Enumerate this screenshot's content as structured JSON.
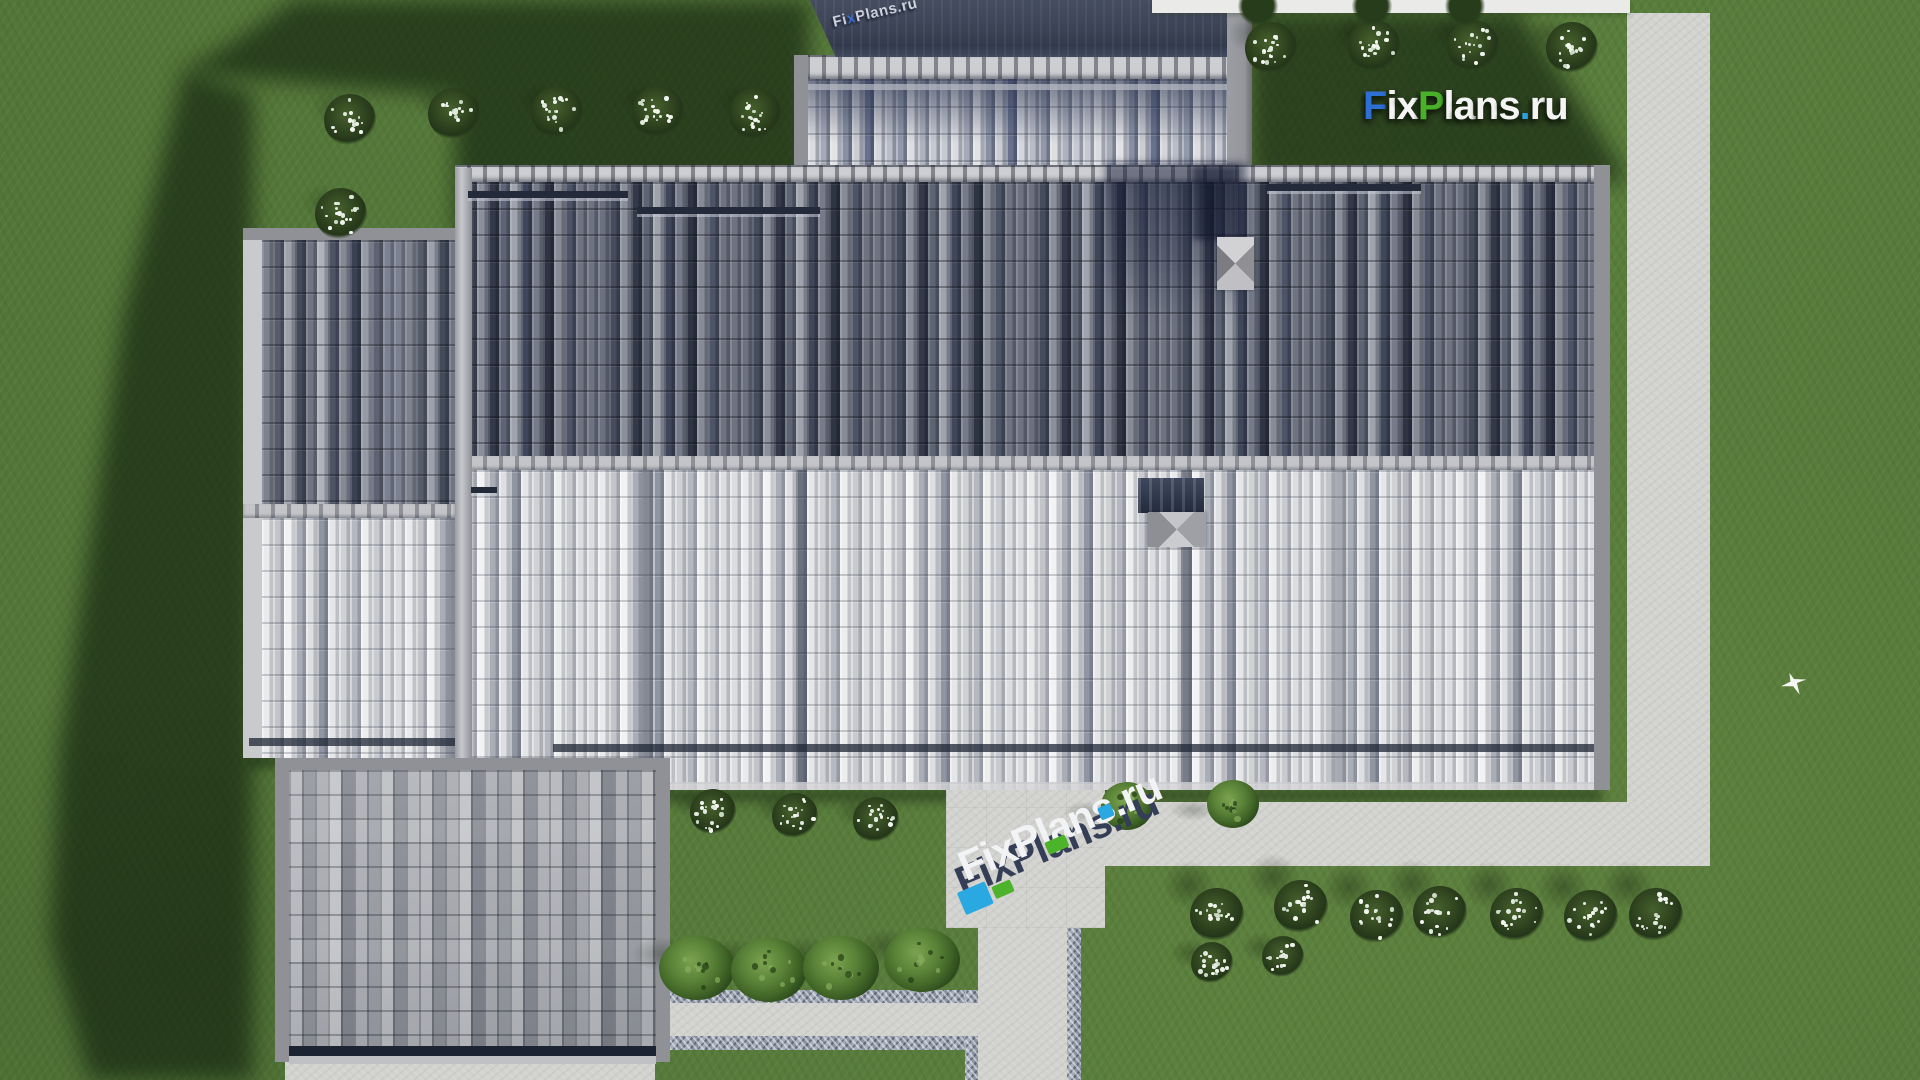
{
  "branding": {
    "logo_text": "FixPlans.ru",
    "logo_letters": [
      {
        "ch": "F",
        "color": "#2e6fd4"
      },
      {
        "ch": "i",
        "color": "#f4f4f4"
      },
      {
        "ch": "x",
        "color": "#f4f4f4"
      },
      {
        "ch": "P",
        "color": "#49b02a"
      },
      {
        "ch": "l",
        "color": "#f4f4f4"
      },
      {
        "ch": "a",
        "color": "#f4f4f4"
      },
      {
        "ch": "n",
        "color": "#f4f4f4"
      },
      {
        "ch": "s",
        "color": "#f4f4f4"
      },
      {
        "ch": ".",
        "color": "#2aa5e2"
      },
      {
        "ch": "r",
        "color": "#f4f4f4"
      },
      {
        "ch": "u",
        "color": "#f4f4f4"
      }
    ],
    "logo_rect": [
      1363,
      84,
      230,
      42
    ],
    "watermark_center": {
      "text": "FixPlans.ru",
      "pos": [
        948,
        862
      ],
      "rotation_deg": -23,
      "face_color": "#343e57",
      "top_color": "#f2f3f5",
      "accents": [
        {
          "x": -4,
          "y": 32,
          "w": 30,
          "h": 24,
          "color": "#29a8e2"
        },
        {
          "x": 30,
          "y": 40,
          "w": 20,
          "h": 13,
          "color": "#4db32a"
        },
        {
          "x": 96,
          "y": 20,
          "w": 22,
          "h": 13,
          "color": "#4db32a"
        },
        {
          "x": 158,
          "y": 9,
          "w": 14,
          "h": 13,
          "color": "#29a8e2"
        }
      ]
    },
    "watermark_top": {
      "text": "FixPlans.ru",
      "pos": [
        833,
        14
      ],
      "rotation_deg": -13,
      "color": "#dde2ea",
      "accent_index": 2,
      "accent_color": "#3b74d8"
    }
  },
  "scene": {
    "colors": {
      "grass": "#567a3a",
      "grass_shadow": "#1c2e15",
      "concrete": "#d2d2cf",
      "gravel": "#9aa2b0",
      "navy_roof": "#3a4254",
      "dark_tiles": "#59606e",
      "light_tiles": "#d7d8db"
    },
    "paths": {
      "right_path": [
        1627,
        13,
        83,
        853
      ],
      "h_path": [
        1105,
        802,
        605,
        64
      ],
      "patio": [
        946,
        790,
        159,
        138
      ],
      "walk": [
        978,
        928,
        89,
        152
      ],
      "walk_gravel_r": [
        1067,
        928,
        14,
        152
      ],
      "walk_gravel_l": [
        965,
        990,
        13,
        90
      ],
      "bpath_gravel_t": [
        670,
        990,
        295,
        13
      ],
      "bpath_concrete": [
        670,
        1003,
        308,
        33
      ],
      "bpath_gravel_b": [
        670,
        1036,
        295,
        14
      ],
      "bottom_strip": [
        285,
        1062,
        370,
        18
      ],
      "white_band": [
        1152,
        0,
        478,
        13
      ],
      "dormer_strip": [
        1227,
        12,
        25,
        153
      ]
    },
    "roof": {
      "lw_left_fascia": [
        243,
        228,
        19,
        530
      ],
      "lw_top_fascia": [
        243,
        228,
        212,
        12
      ],
      "lw_dark": [
        262,
        240,
        193,
        264
      ],
      "lw_ridge": [
        243,
        504,
        212,
        14
      ],
      "lw_light": [
        262,
        518,
        193,
        240
      ],
      "lw_gutter": [
        249,
        738,
        206,
        8
      ],
      "main_topridge": [
        455,
        165,
        1147,
        17
      ],
      "main_dark": [
        455,
        182,
        1147,
        274
      ],
      "main_ridge": [
        455,
        456,
        1147,
        14
      ],
      "main_light": [
        455,
        470,
        1147,
        320
      ],
      "main_right_fascia": [
        1594,
        165,
        16,
        625
      ],
      "divider": [
        455,
        168,
        17,
        622
      ],
      "snowguard1": [
        468,
        191,
        160,
        7
      ],
      "snowguard2": [
        637,
        207,
        183,
        7
      ],
      "snowguard3": [
        1267,
        184,
        154,
        7
      ],
      "vent_mark": [
        471,
        487,
        26,
        6
      ],
      "main_gutter": [
        553,
        744,
        1041,
        8
      ],
      "main_fascia_line": [
        670,
        782,
        924,
        8
      ],
      "blr_fascia_t": [
        275,
        758,
        395,
        12
      ],
      "blr_fascia_l": [
        275,
        758,
        14,
        304
      ],
      "blr_fascia_r": [
        656,
        758,
        14,
        304
      ],
      "blr_tiles": [
        289,
        770,
        367,
        292
      ],
      "blr_gutter": [
        289,
        1046,
        367,
        10
      ],
      "blr_lightrow": [
        289,
        1056,
        367,
        8
      ],
      "dormer_fascia_l": [
        794,
        55,
        14,
        110
      ],
      "dormer_ridge": [
        794,
        55,
        451,
        24
      ],
      "dormer_tiles": [
        808,
        79,
        419,
        86
      ],
      "dormer_seam": [
        808,
        84,
        419,
        6
      ],
      "navy_face": [
        806,
        0,
        426,
        57
      ],
      "chimney_top_cap": [
        1217,
        237,
        37,
        53
      ],
      "chimney_low_panel": [
        1138,
        478,
        66,
        35
      ],
      "chimney_low_cap": [
        1148,
        512,
        58,
        35
      ]
    },
    "shadows": {
      "top_left": [
        150,
        0,
        660,
        240
      ],
      "left": [
        40,
        60,
        215,
        1020
      ],
      "top_right": [
        1245,
        10,
        390,
        175
      ],
      "eave_main": [
        553,
        788,
        1049,
        14
      ],
      "eave_lw": [
        249,
        754,
        211,
        14
      ],
      "dormer_on_roof": [
        1105,
        163,
        142,
        158
      ],
      "chimney_streak": [
        1193,
        166,
        44,
        74
      ]
    },
    "bushes_white_groups": [
      {
        "name": "top-left-row",
        "r": 26,
        "shadow": [
          -18,
          -12,
          44,
          36,
          0.35
        ],
        "pts": [
          [
            350,
            120
          ],
          [
            454,
            114
          ],
          [
            557,
            112
          ],
          [
            658,
            112
          ],
          [
            755,
            114
          ],
          [
            341,
            214
          ]
        ]
      },
      {
        "name": "top-right-row",
        "r": 26,
        "shadow": [
          -20,
          -14,
          46,
          38,
          0.45
        ],
        "pts": [
          [
            1271,
            48
          ],
          [
            1374,
            46
          ],
          [
            1473,
            46
          ],
          [
            1572,
            48
          ]
        ]
      },
      {
        "name": "below-eave",
        "r": 23,
        "shadow": [
          -20,
          -8,
          42,
          30,
          0.45
        ],
        "pts": [
          [
            713,
            812
          ],
          [
            795,
            816
          ],
          [
            876,
            820
          ]
        ]
      },
      {
        "name": "bottom-row",
        "r": 27,
        "shadow": [
          -28,
          -30,
          52,
          48,
          0.6
        ],
        "pts": [
          [
            1217,
            915
          ],
          [
            1301,
            907
          ],
          [
            1377,
            917
          ],
          [
            1440,
            913
          ],
          [
            1517,
            915
          ],
          [
            1591,
            917
          ],
          [
            1656,
            915
          ]
        ]
      },
      {
        "name": "walk-pair",
        "r": 21,
        "shadow": [
          -22,
          -10,
          40,
          30,
          0.5
        ],
        "pts": [
          [
            1212,
            963
          ],
          [
            1283,
            957
          ]
        ]
      }
    ],
    "bushes_green_groups": [
      {
        "name": "bottom-green-row",
        "rx": 38,
        "ry": 32,
        "shadow": [
          -36,
          -14,
          60,
          34,
          0.5
        ],
        "pts": [
          [
            697,
            968
          ],
          [
            769,
            970
          ],
          [
            841,
            968
          ],
          [
            922,
            960
          ]
        ]
      },
      {
        "name": "patio-side",
        "rx": 26,
        "ry": 24,
        "shadow": [
          -40,
          6,
          48,
          22,
          0.45
        ],
        "pts": [
          [
            1127,
            806
          ],
          [
            1233,
            804
          ]
        ]
      }
    ],
    "tree_crowns": {
      "r": 20,
      "pts": [
        [
          1258,
          6
        ],
        [
          1372,
          6
        ],
        [
          1465,
          6
        ]
      ]
    },
    "bird": [
      1781,
      672,
      26,
      24
    ]
  }
}
